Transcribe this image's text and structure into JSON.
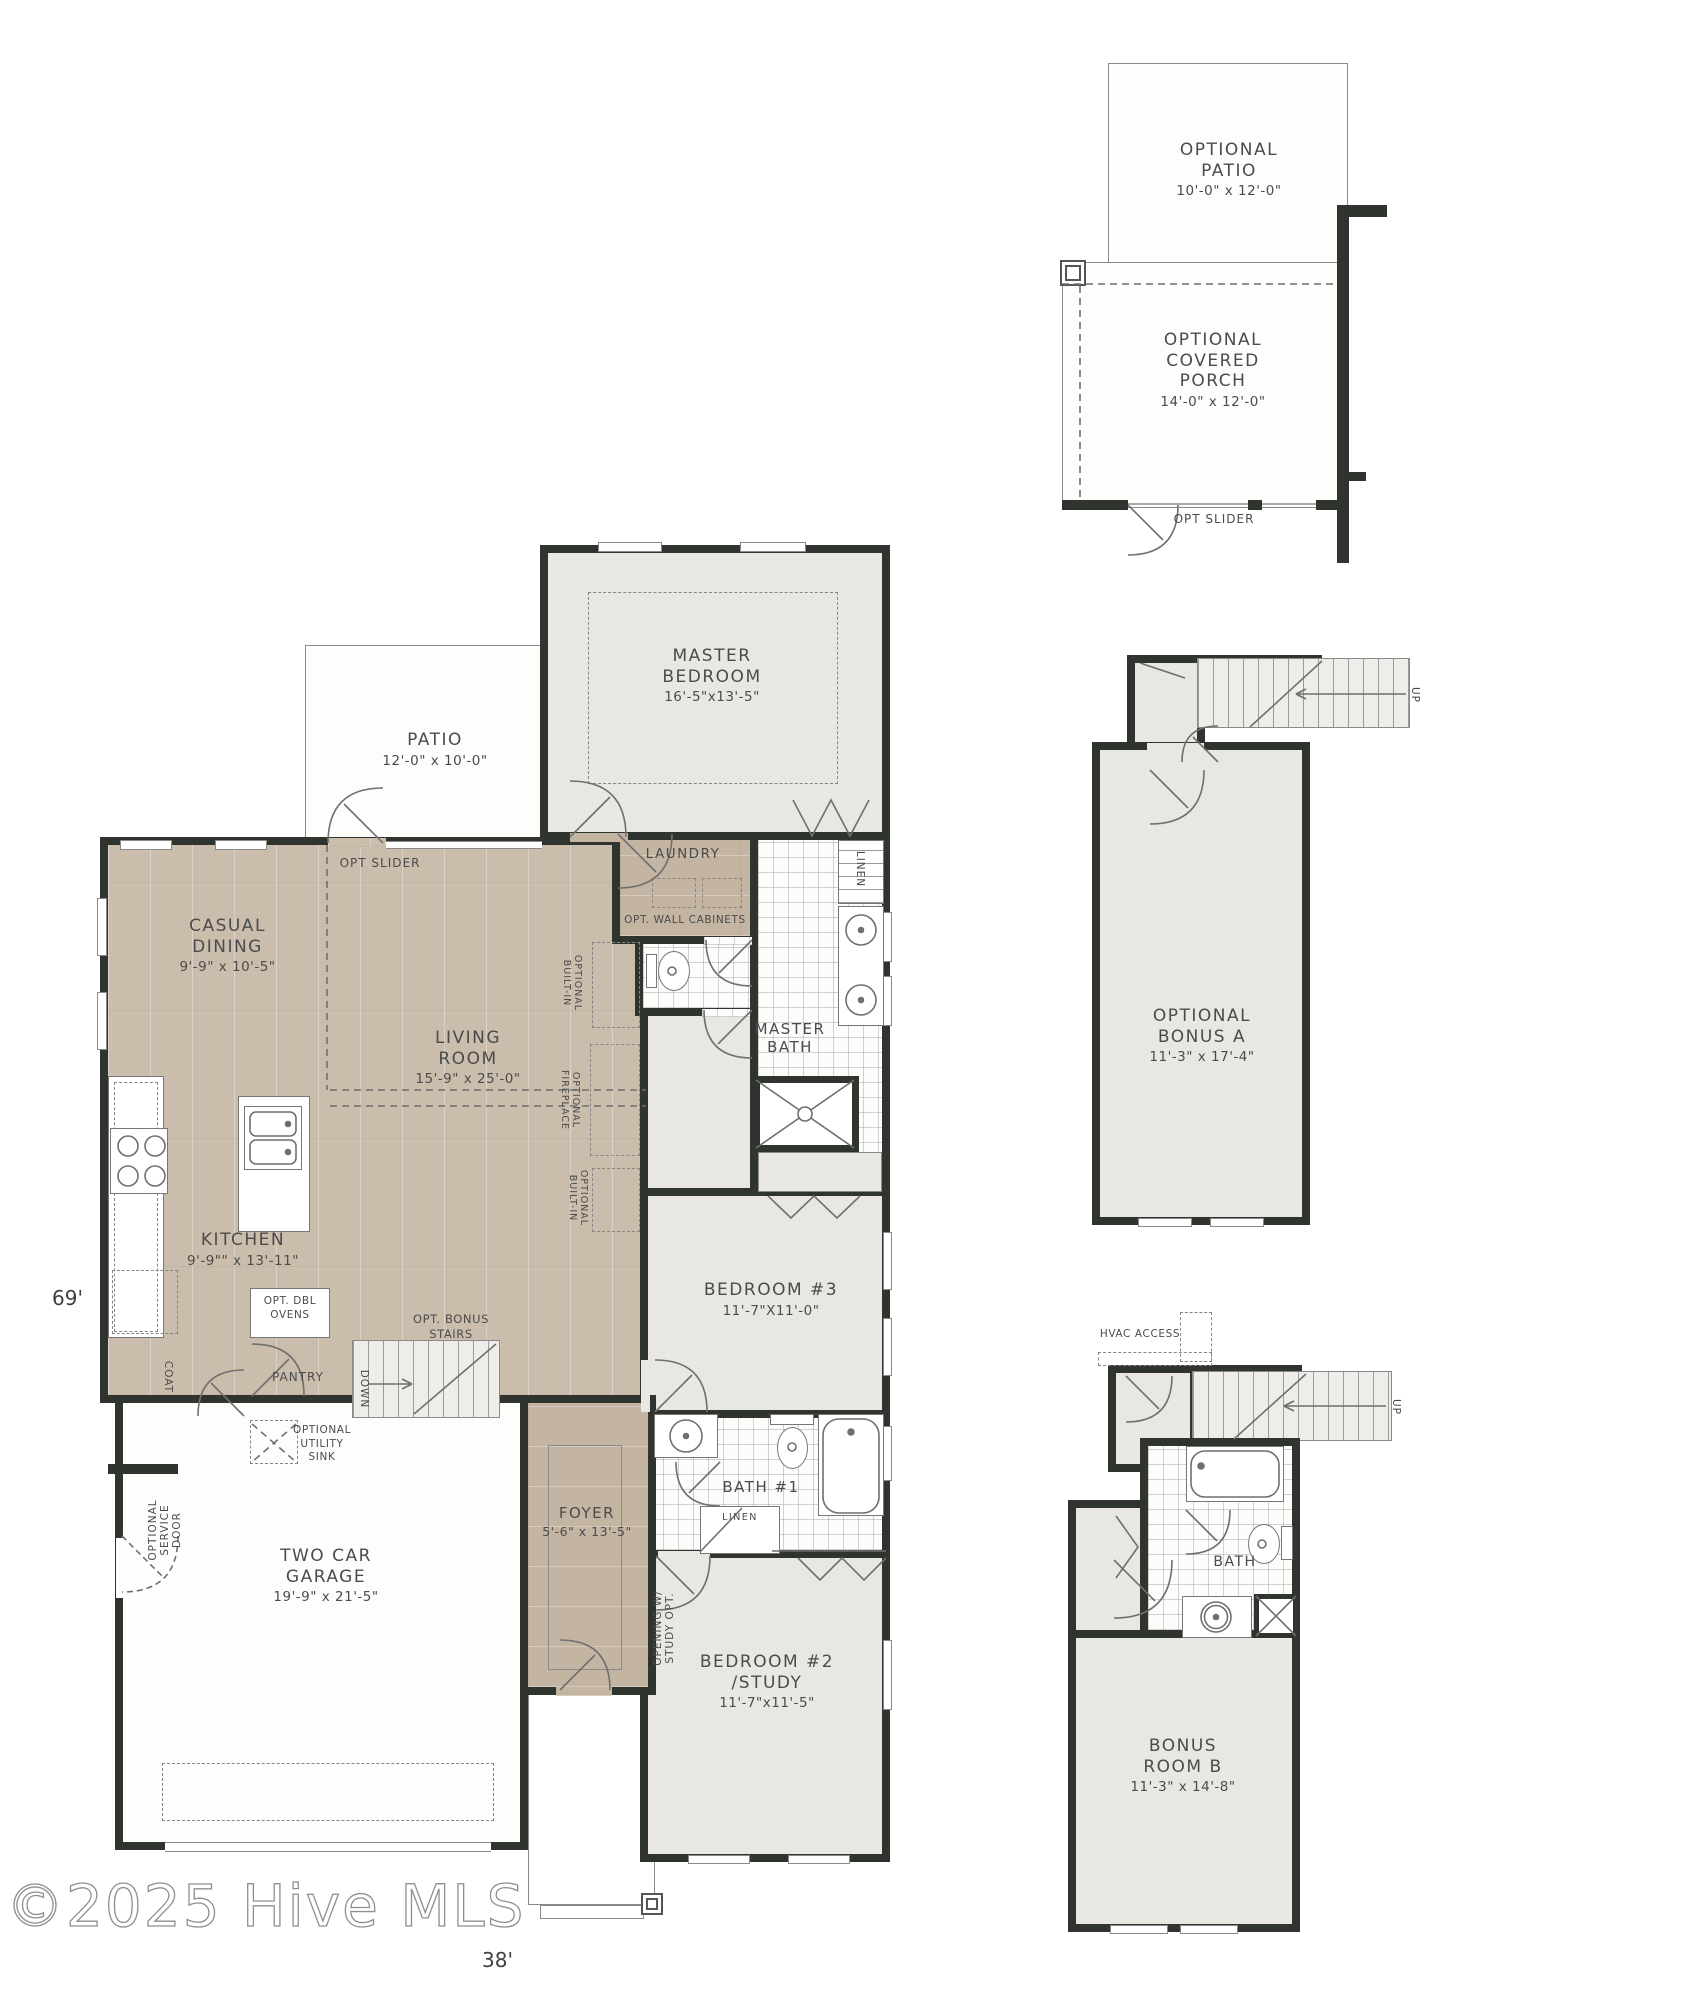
{
  "watermark": "©2025 Hive MLS",
  "dimensions": {
    "depth": "69'",
    "width": "38'"
  },
  "main": {
    "patio": {
      "name": "PATIO",
      "size": "12'-0\" x 10'-0\""
    },
    "opt_slider": "OPT SLIDER",
    "master_bedroom": {
      "name1": "MASTER",
      "name2": "BEDROOM",
      "size": "16'-5\"x13'-5\""
    },
    "laundry": {
      "name": "LAUNDRY"
    },
    "opt_wall_cabinets": "OPT. WALL CABINETS",
    "linen_master": "LINEN",
    "master_bath": {
      "name1": "MASTER",
      "name2": "BATH"
    },
    "casual_dining": {
      "name1": "CASUAL",
      "name2": "DINING",
      "size": "9'-9\" x 10'-5\""
    },
    "living_room": {
      "name1": "LIVING",
      "name2": "ROOM",
      "size": "15'-9\" x 25'-0\""
    },
    "kitchen": {
      "name": "KITCHEN",
      "size": "9'-9\"\" x 13'-11\""
    },
    "opt_dbl_ovens": {
      "l1": "OPT. DBL",
      "l2": "OVENS"
    },
    "coat": "COAT",
    "pantry": "PANTRY",
    "opt_bonus_stairs": {
      "l1": "OPT. BONUS",
      "l2": "STAIRS"
    },
    "down": "DOWN",
    "opt_utility_sink": {
      "l1": "OPTIONAL",
      "l2": "UTILITY",
      "l3": "SINK"
    },
    "opt_service_door": {
      "l1": "OPTIONAL",
      "l2": "SERVICE",
      "l3": "DOOR"
    },
    "garage": {
      "name1": "TWO CAR",
      "name2": "GARAGE",
      "size": "19'-9\" x 21'-5\""
    },
    "bedroom3": {
      "name": "BEDROOM #3",
      "size": "11'-7\"X11'-0\""
    },
    "bath1": {
      "name": "BATH #1"
    },
    "linen_bath1": "LINEN",
    "foyer": {
      "name": "FOYER",
      "size": "5'-6\" x 13'-5\""
    },
    "opening_study": {
      "l1": "OPENING W/",
      "l2": "STUDY OPT."
    },
    "bedroom2": {
      "name1": "BEDROOM #2",
      "name2": "/STUDY",
      "size": "11'-7\"x11'-5\""
    },
    "opt_builtin_upper": {
      "l1": "OPTIONAL",
      "l2": "BUILT-IN"
    },
    "opt_fireplace": {
      "l1": "OPTIONAL",
      "l2": "FIREPLACE"
    },
    "opt_builtin_lower": {
      "l1": "OPTIONAL",
      "l2": "BUILT-IN"
    }
  },
  "options": {
    "opt_patio": {
      "name1": "OPTIONAL",
      "name2": "PATIO",
      "size": "10'-0\" x 12'-0\""
    },
    "covered_porch": {
      "name1": "OPTIONAL",
      "name2": "COVERED",
      "name3": "PORCH",
      "size": "14'-0\" x 12'-0\""
    },
    "opt_slider": "OPT SLIDER",
    "bonus_a": {
      "name1": "OPTIONAL",
      "name2": "BONUS A",
      "size": "11'-3\" x 17'-4\"",
      "up": "UP"
    },
    "bonus_b": {
      "name1": "BONUS",
      "name2": "ROOM B",
      "size": "11'-3\" x 14'-8\"",
      "up": "UP",
      "bath": "BATH",
      "hvac1": "HVAC",
      "hvac2": "ACCESS"
    }
  }
}
